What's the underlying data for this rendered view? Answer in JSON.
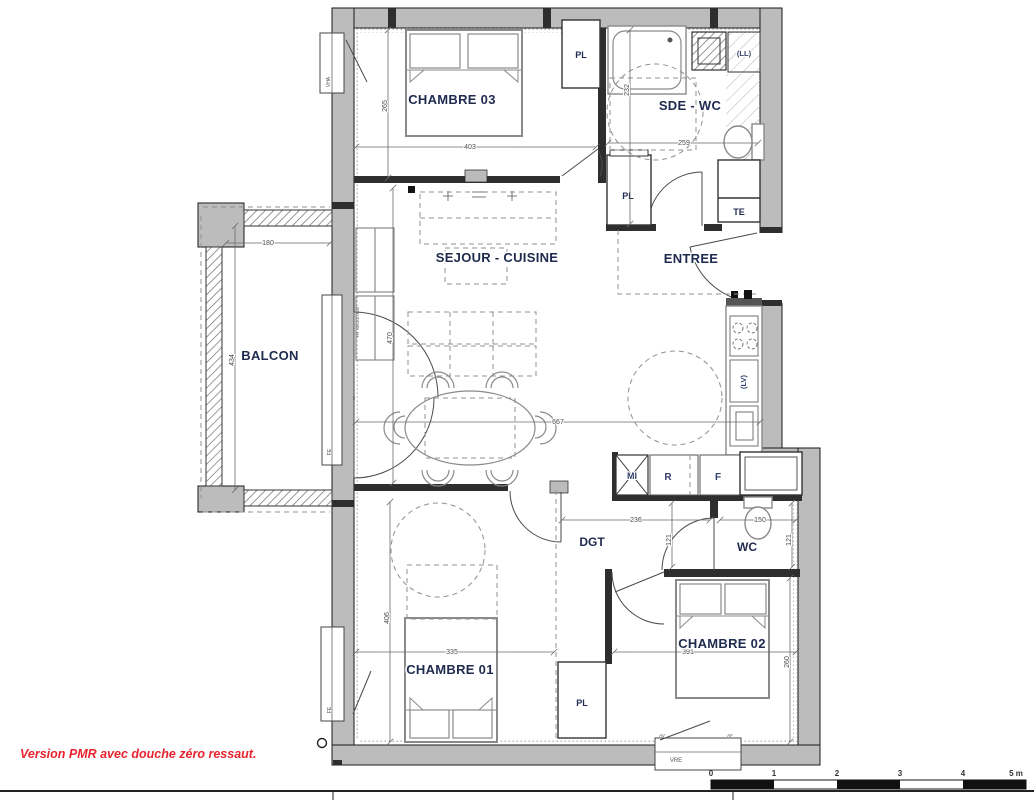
{
  "rooms": {
    "chambre03": "CHAMBRE 03",
    "sde_wc": "SDE - WC",
    "sejour_cuisine": "SEJOUR - CUISINE",
    "entree": "ENTREE",
    "balcon": "BALCON",
    "chambre01": "CHAMBRE 01",
    "dgt": "DGT",
    "wc": "WC",
    "chambre02": "CHAMBRE 02"
  },
  "storage": {
    "pl": "PL",
    "te": "TE"
  },
  "appliances": {
    "washer": "(LL)",
    "dishwasher": "(LV)",
    "microwave": "MI",
    "fridge": "R",
    "oven": "F"
  },
  "dimensions_cm": {
    "chambre03_width": "403",
    "chambre03_height": "265",
    "sde_wc_height": "232",
    "sde_wc_width": "259",
    "balcon_width": "180",
    "balcon_height": "434",
    "sejour_height": "470",
    "sejour_width": "667",
    "chambre01_width": "335",
    "chambre01_height": "406",
    "dgt_width": "236",
    "dgt_height": "121",
    "wc_width": "150",
    "wc_height": "121",
    "chambre02_width": "391",
    "chambre02_height": "260"
  },
  "window_tags": {
    "chambre03": "VHA",
    "balcon_door_threshold": "HT SEUIL 0.03",
    "balcon_window": "FE",
    "chambre01_window": "FE",
    "chambre02_window": "VRE",
    "window_mark_left": "AV",
    "window_mark_right": "AF"
  },
  "note": {
    "text": "Version PMR avec douche zéro ressaut."
  },
  "scale_bar": {
    "ticks": [
      "0",
      "1",
      "2",
      "3",
      "4",
      "5 m"
    ]
  }
}
